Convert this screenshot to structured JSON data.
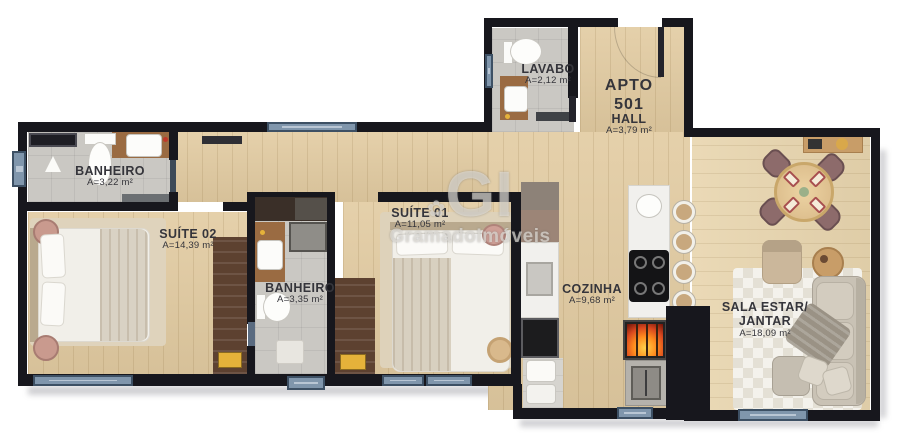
{
  "apartment": {
    "label_line1": "APTO",
    "label_line2": "501"
  },
  "rooms": {
    "banheiro_suite": {
      "name": "BANHEIRO",
      "area": "A=3,22 m²"
    },
    "suite02": {
      "name": "SUÍTE 02",
      "area": "A=14,39 m²"
    },
    "banheiro_social": {
      "name": "BANHEIRO",
      "area": "A=3,35 m²"
    },
    "suite01": {
      "name": "SUÍTE 01",
      "area": "A=11,05 m²"
    },
    "lavabo": {
      "name": "LAVABO",
      "area": "A=2,12 m²"
    },
    "hall": {
      "name": "HALL",
      "area": "A=3,79 m²"
    },
    "cozinha": {
      "name": "COZINHA",
      "area": "A=9,68 m²"
    },
    "sala": {
      "name_line1": "SALA ESTAR/",
      "name_line2": "JANTAR",
      "area": "A=18,09 m²"
    }
  },
  "watermark": {
    "flower": "✿",
    "initials": "GI",
    "name": "GramadoImóveis"
  },
  "colors": {
    "wall": "#17171d",
    "wood_floor": "#e2cba1",
    "living_floor": "#e8d5ae",
    "tile": "#cac8c3",
    "window_glass": "#8096ac",
    "window_frame": "#3d5064",
    "wardrobe": "#5d4130",
    "drawer_accent": "#e5b23a",
    "fire": "#ff8c1e",
    "chair": "#8d6b6b",
    "sofa": "#c9c2b5"
  }
}
